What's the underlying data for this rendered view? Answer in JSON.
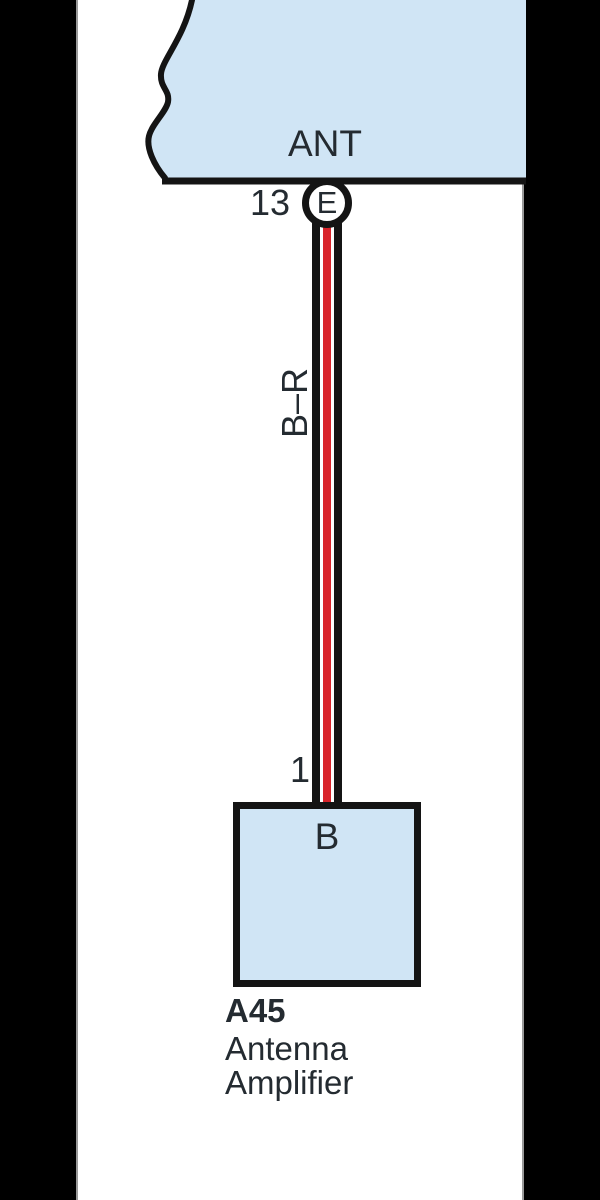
{
  "diagram": {
    "source_component": {
      "label": "ANT"
    },
    "connector": {
      "pin": "13",
      "id": "E"
    },
    "wire": {
      "color_code": "B–R"
    },
    "amplifier": {
      "pin": "1",
      "terminal": "B",
      "id": "A45",
      "name_line1": "Antenna",
      "name_line2": "Amplifier"
    },
    "colors": {
      "component_fill": "#d0e5f5",
      "outline": "#141414",
      "wire_red": "#d8232a",
      "canvas": "#ffffff",
      "letterbox": "#000000"
    }
  }
}
